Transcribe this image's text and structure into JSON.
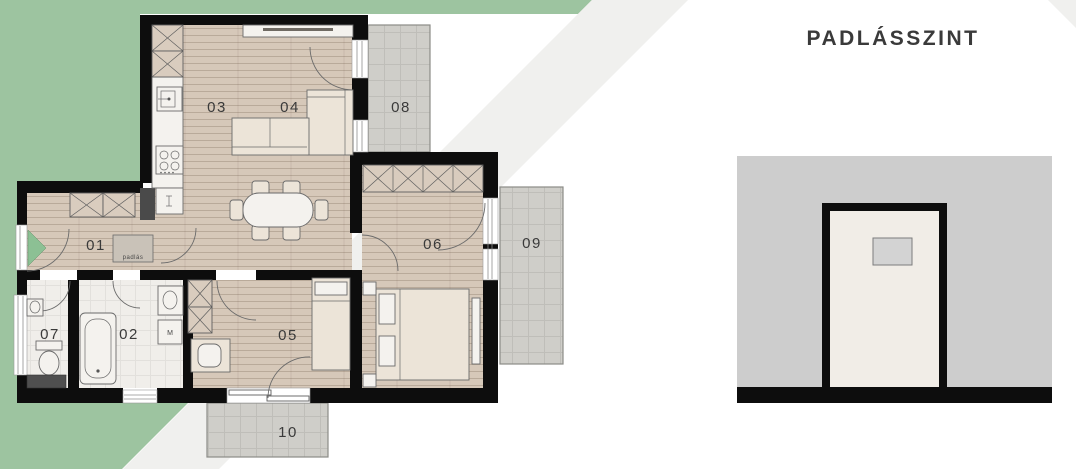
{
  "title": "PADLÁSSZINT",
  "floorplan": {
    "rooms": [
      {
        "id": "01"
      },
      {
        "id": "02"
      },
      {
        "id": "03"
      },
      {
        "id": "04"
      },
      {
        "id": "05"
      },
      {
        "id": "06"
      },
      {
        "id": "07"
      },
      {
        "id": "08"
      },
      {
        "id": "09"
      },
      {
        "id": "10"
      }
    ],
    "attic_hatch_label": "padlás",
    "washer_label": "M"
  },
  "theme": {
    "garden_green": "#9dc4a0",
    "walkway_gray": "#f0f0ee",
    "wall_black": "#0d0d0d",
    "wood_floor": "#d6c8b9",
    "tile_floor": "#f0eeea",
    "terrace_gray": "#cfcec9",
    "door_marker_green": "#8cc094",
    "shaft_gray": "#4a4a4a",
    "text_dark": "#3a3a3a",
    "attic_bg": "#cdcdcd",
    "attic_room": "#f1ede7"
  }
}
